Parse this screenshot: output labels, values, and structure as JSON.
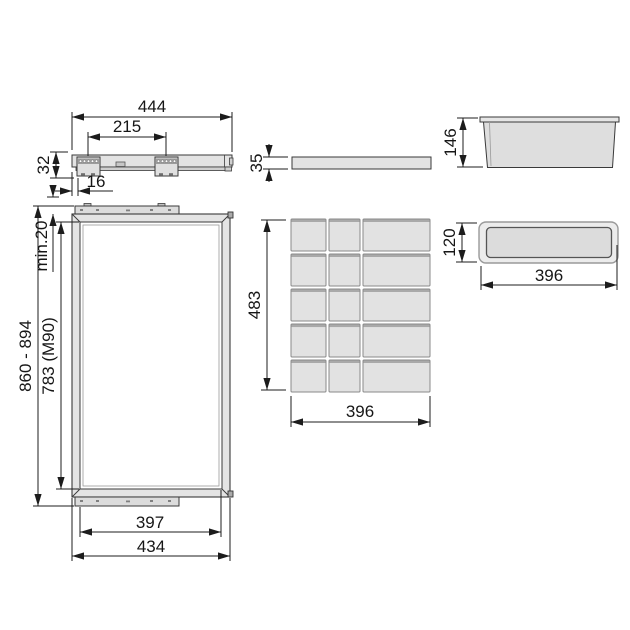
{
  "drawing": {
    "type": "technical-dimension-drawing",
    "background_color": "#ffffff",
    "line_color": "#1c1c1c",
    "fill_color": "#e3e3e3",
    "views": {
      "slide_rail_side": {
        "description": "drawer slide rail side view with two mounting brackets",
        "dims": {
          "length": "444",
          "bracket_spacing": "215",
          "height": "32",
          "front_offset": "16"
        }
      },
      "frame_front": {
        "description": "pull-out frame front view with top and bottom rails",
        "dims": {
          "total_height": "860 - 894",
          "clearance": "min.20",
          "inner_height": "783 (M90)",
          "inner_width": "397",
          "outer_width": "434"
        }
      },
      "base_panel_side": {
        "description": "thin base panel side view",
        "dims": {
          "thickness": "35"
        }
      },
      "divider_grid_top": {
        "description": "divider tray top view",
        "rows": 5,
        "columns": 3,
        "dims": {
          "depth": "483",
          "width": "396"
        }
      },
      "tray_side": {
        "description": "storage tray side view with rim",
        "dims": {
          "height": "146"
        }
      },
      "tray_top": {
        "description": "storage tray top view, rounded rectangle",
        "dims": {
          "height": "120",
          "width": "396"
        }
      }
    }
  }
}
